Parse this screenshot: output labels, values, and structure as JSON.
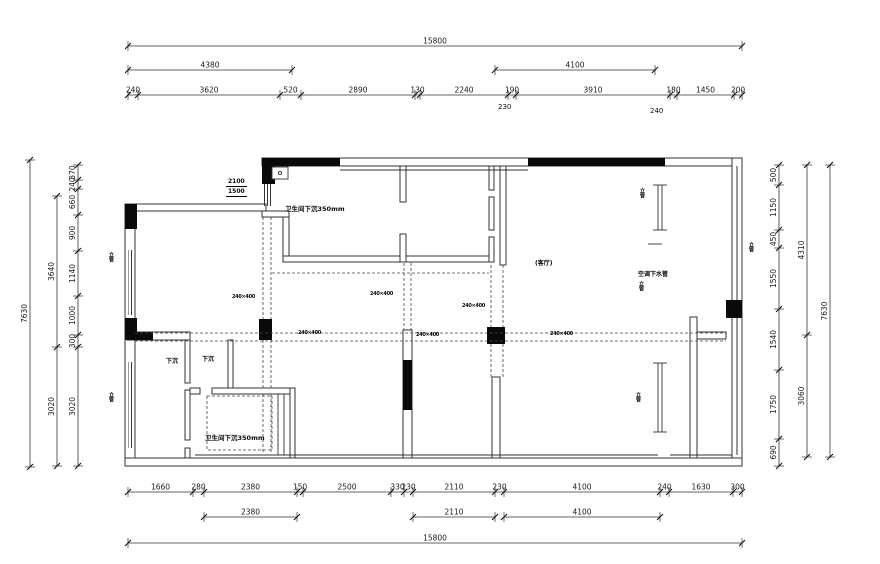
{
  "drawing": {
    "kind": "architectural floor plan",
    "units": "mm"
  },
  "dims": {
    "top": {
      "overall": "15800",
      "span_left": "4380",
      "span_right": "4100",
      "chain": [
        "240",
        "3620",
        "520",
        "2890",
        "130",
        "2240",
        "190",
        "3910",
        "180",
        "1450",
        "200"
      ],
      "sub": [
        "230",
        "240"
      ]
    },
    "bottom": {
      "chain": [
        "1660",
        "280",
        "2380",
        "150",
        "2500",
        "330",
        "230",
        "2110",
        "230",
        "4100",
        "240",
        "1630",
        "300"
      ],
      "spans": [
        "2380",
        "2110",
        "4100"
      ],
      "overall": "15800"
    },
    "left": {
      "chain": [
        "370",
        "240",
        "660",
        "900",
        "1140",
        "1000",
        "300",
        "3020"
      ],
      "spans": [
        "3640",
        "3020"
      ],
      "overall": "7630"
    },
    "right": {
      "chain": [
        "500",
        "1150",
        "450",
        "1550",
        "1540",
        "1750",
        "690"
      ],
      "spans": [
        "4310",
        "3060"
      ],
      "overall": "7630"
    }
  },
  "annotations": {
    "window_tag": {
      "line1": "2100",
      "line2": "1500"
    },
    "bath_top": "卫生间下沉350mm",
    "bath_bottom": "卫生间下沉350mm",
    "sunken_a": "下沉",
    "sunken_b": "下沉",
    "living": "(客厅)",
    "ac_drain": "空调下水管",
    "riser": "立管",
    "beam_tag": "240×400"
  }
}
